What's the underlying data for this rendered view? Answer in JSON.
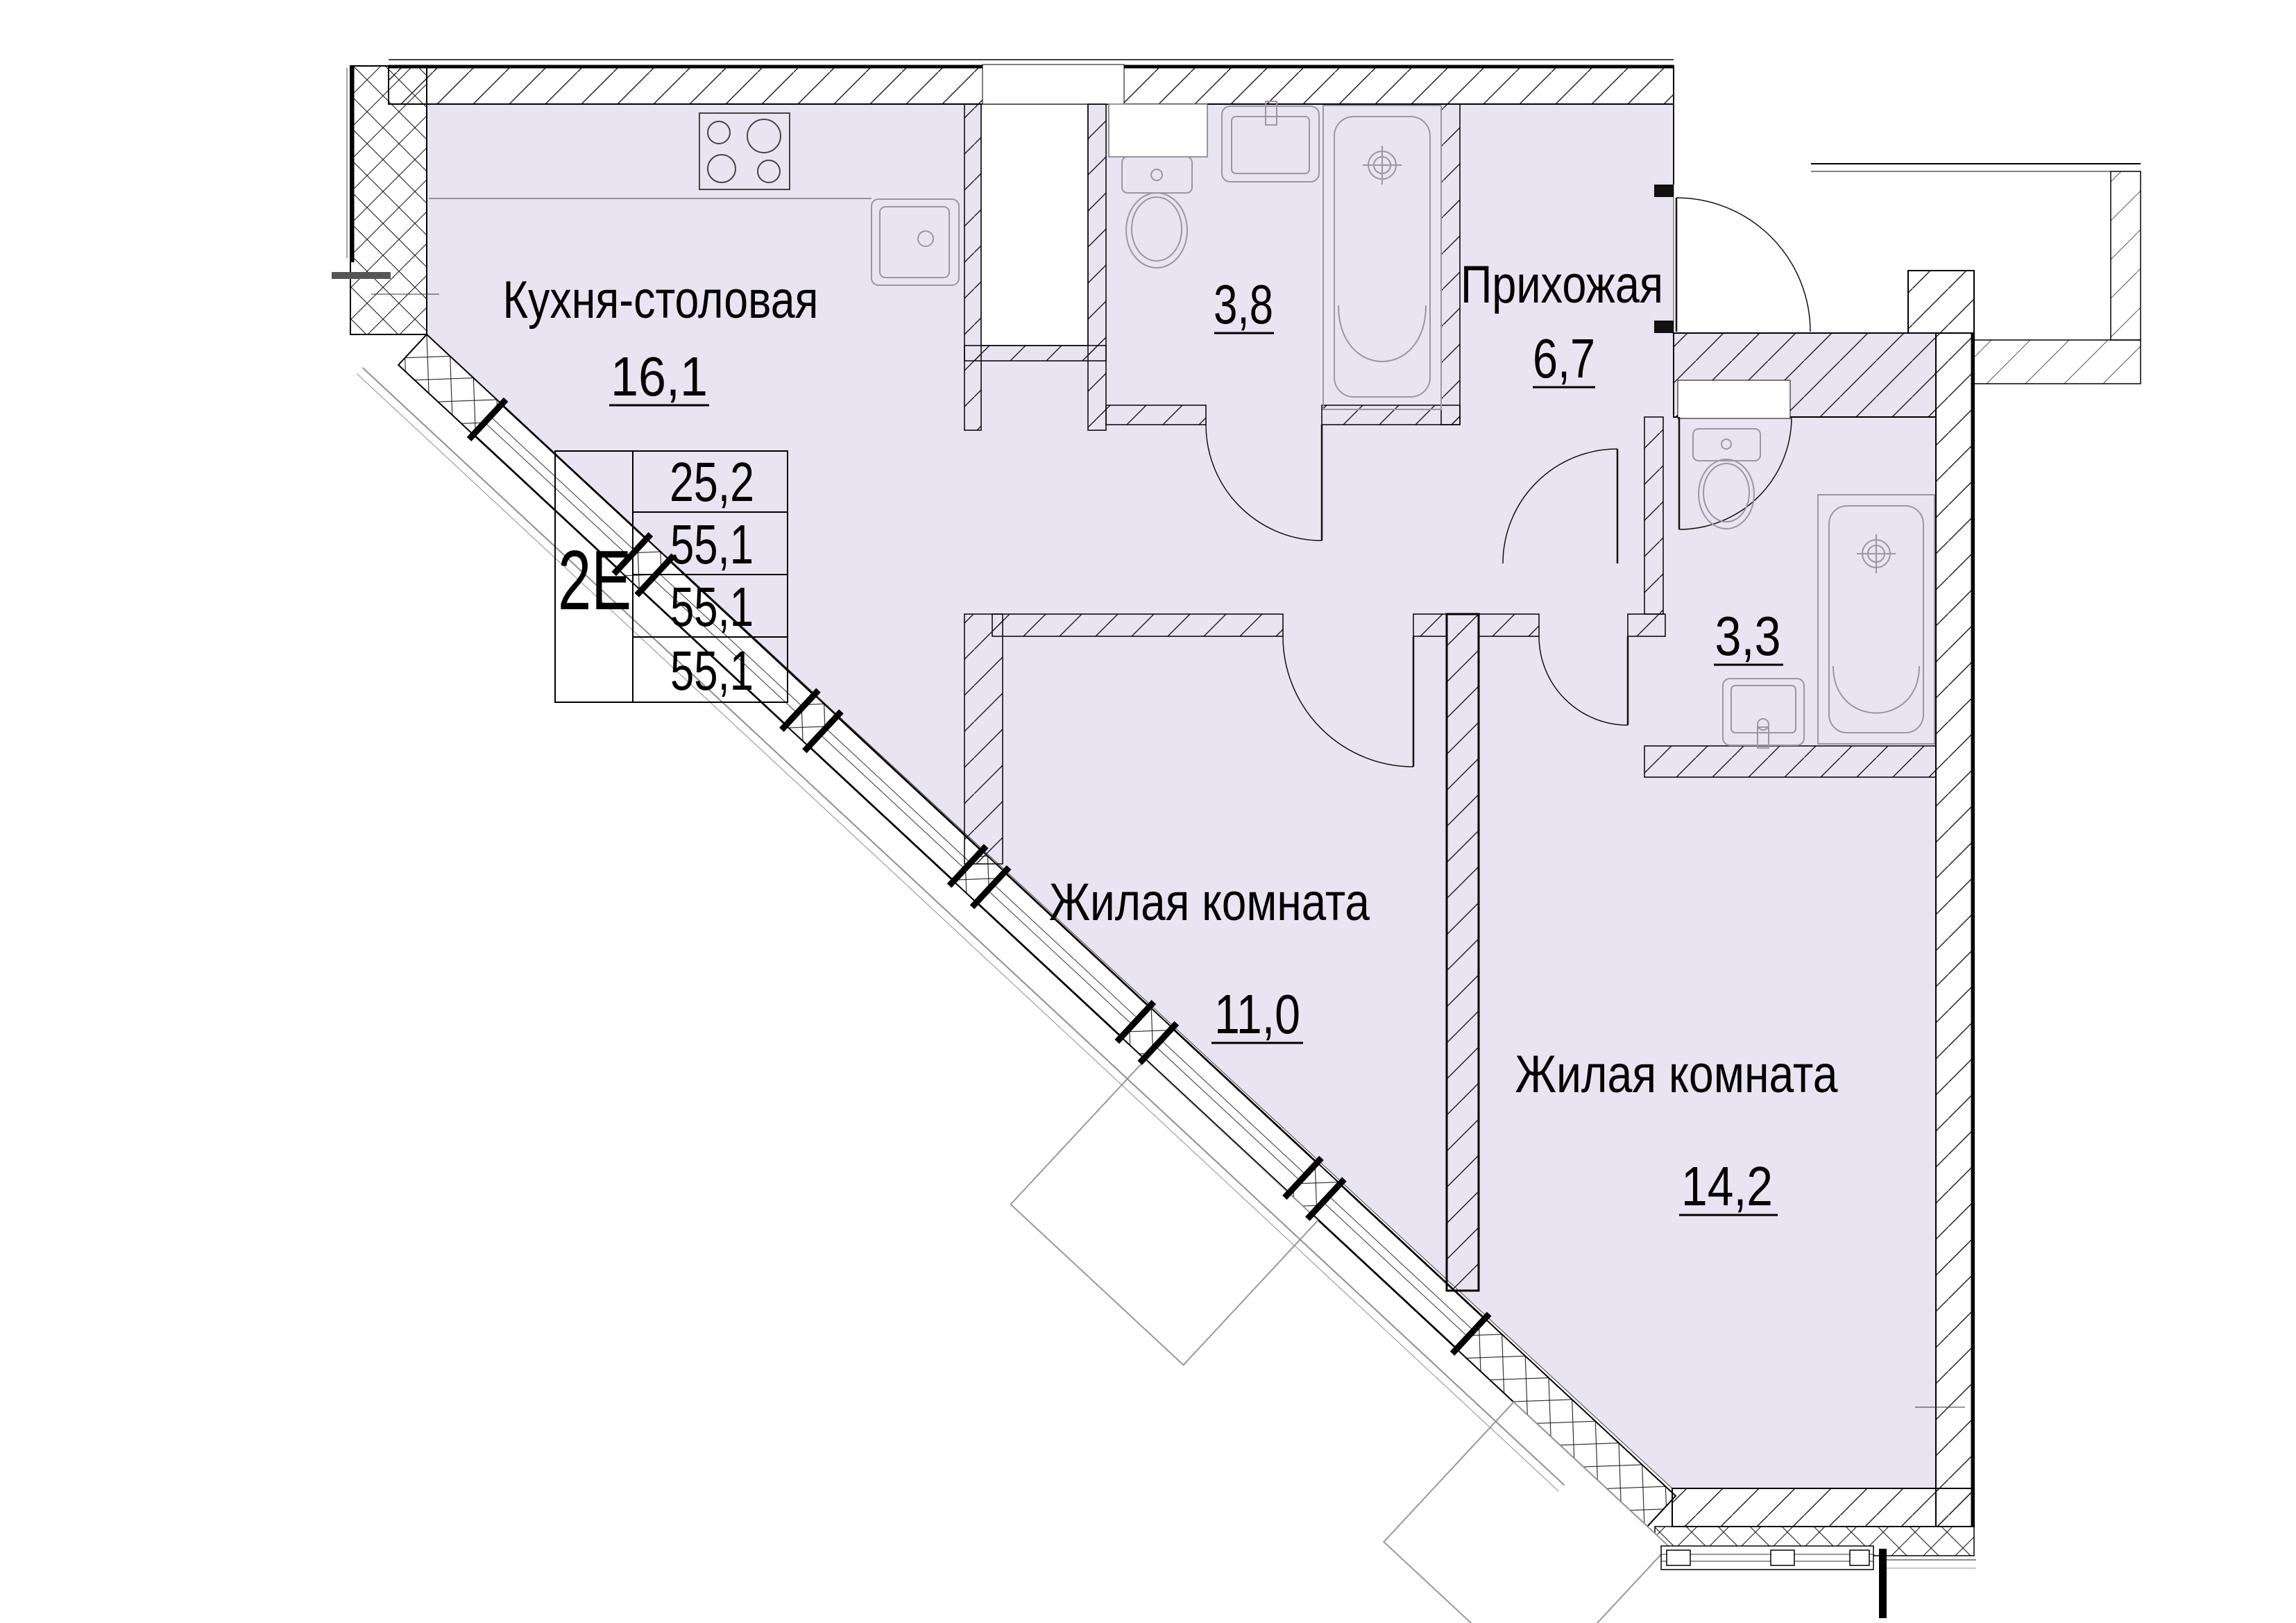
{
  "plan": {
    "apartment_type": "2Е",
    "area_table": {
      "rows": [
        "25,2",
        "55,1",
        "55,1",
        "55,1"
      ]
    },
    "rooms": {
      "kitchen": {
        "name": "Кухня-столовая",
        "area": "16,1"
      },
      "bathroom_big": {
        "area": "3,8"
      },
      "hallway": {
        "name": "Прихожая",
        "area": "6,7"
      },
      "bathroom_small": {
        "area": "3,3"
      },
      "living1": {
        "name": "Жилая комната",
        "area": "11,0"
      },
      "living2": {
        "name": "Жилая комната",
        "area": "14,2"
      }
    },
    "colors": {
      "room_fill": "#e8e4f1",
      "wall_line": "#000000",
      "fixture_line": "#9a96a4"
    }
  }
}
